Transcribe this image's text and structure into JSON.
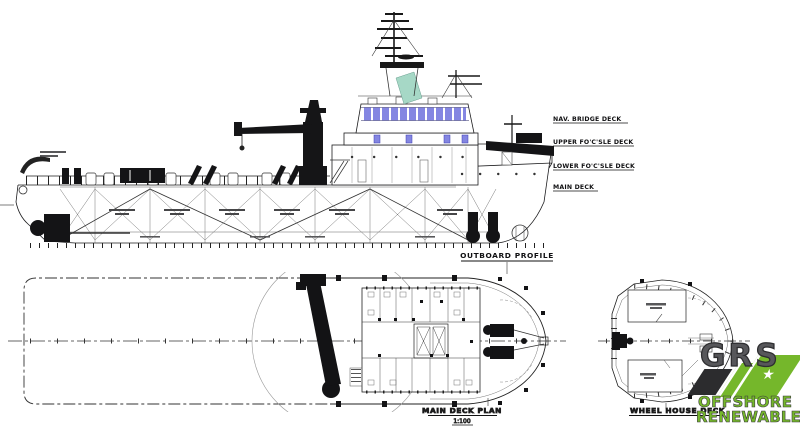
{
  "profile": {
    "title": "OUTBOARD PROFILE",
    "deck_labels": [
      {
        "label": "NAV. BRIDGE DECK"
      },
      {
        "label": "UPPER FO'C'SLE DECK"
      },
      {
        "label": "LOWER FO'C'SLE DECK"
      },
      {
        "label": "MAIN DECK"
      }
    ]
  },
  "main_deck_plan": {
    "title": "MAIN DECK PLAN",
    "scale": "1:100"
  },
  "wheelhouse_plan": {
    "title": "WHEEL HOUSE DECK"
  },
  "logo": {
    "name": "GRS",
    "line1": "OFFSHORE",
    "line2": "RENEWABLES",
    "star": "★",
    "green": "#75b72b",
    "dark": "#2c2c2e"
  },
  "colors": {
    "window_blue": "#8486e2",
    "exhaust_teal": "#a6d8c6",
    "ink": "#1c1c1e"
  }
}
